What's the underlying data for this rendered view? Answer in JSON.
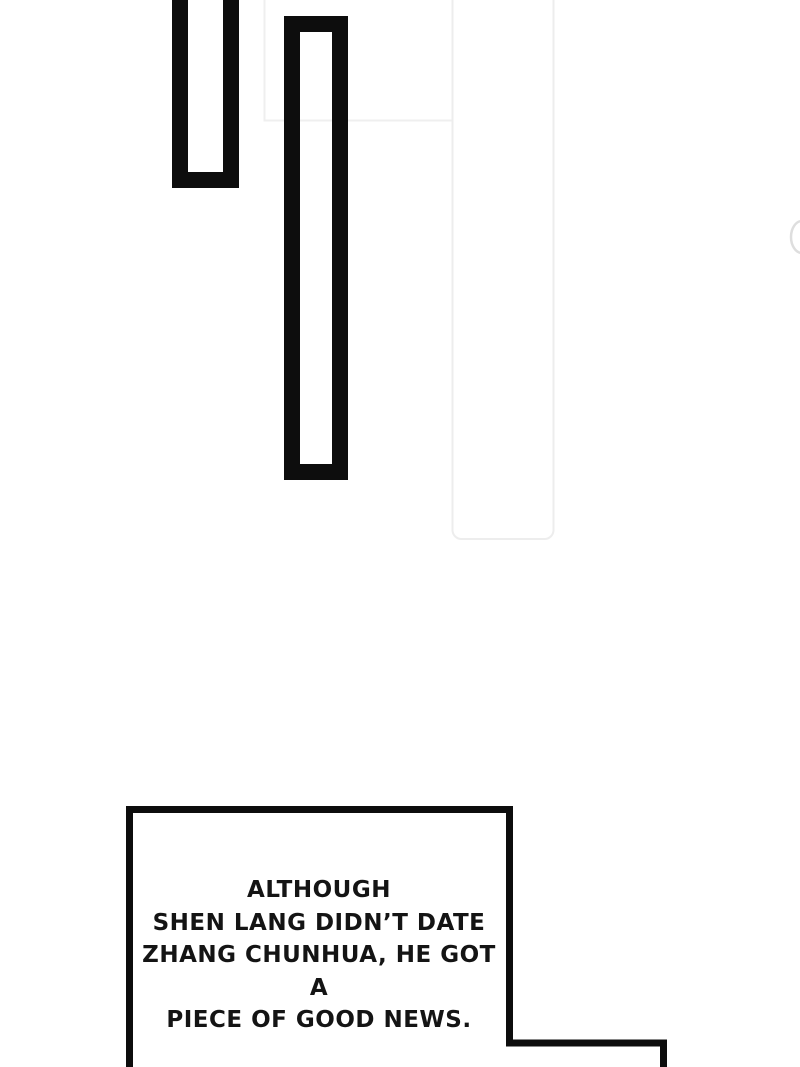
{
  "page": {
    "background_color": "#ffffff",
    "ink_color": "#0d0d0d",
    "faint_line_color": "#ececec"
  },
  "caption": {
    "text": "ALTHOUGH\nSHEN LANG DIDN’T DATE\nZHANG CHUNHUA, HE GOT A\nPIECE OF GOOD NEWS.",
    "text_color": "#141414"
  }
}
